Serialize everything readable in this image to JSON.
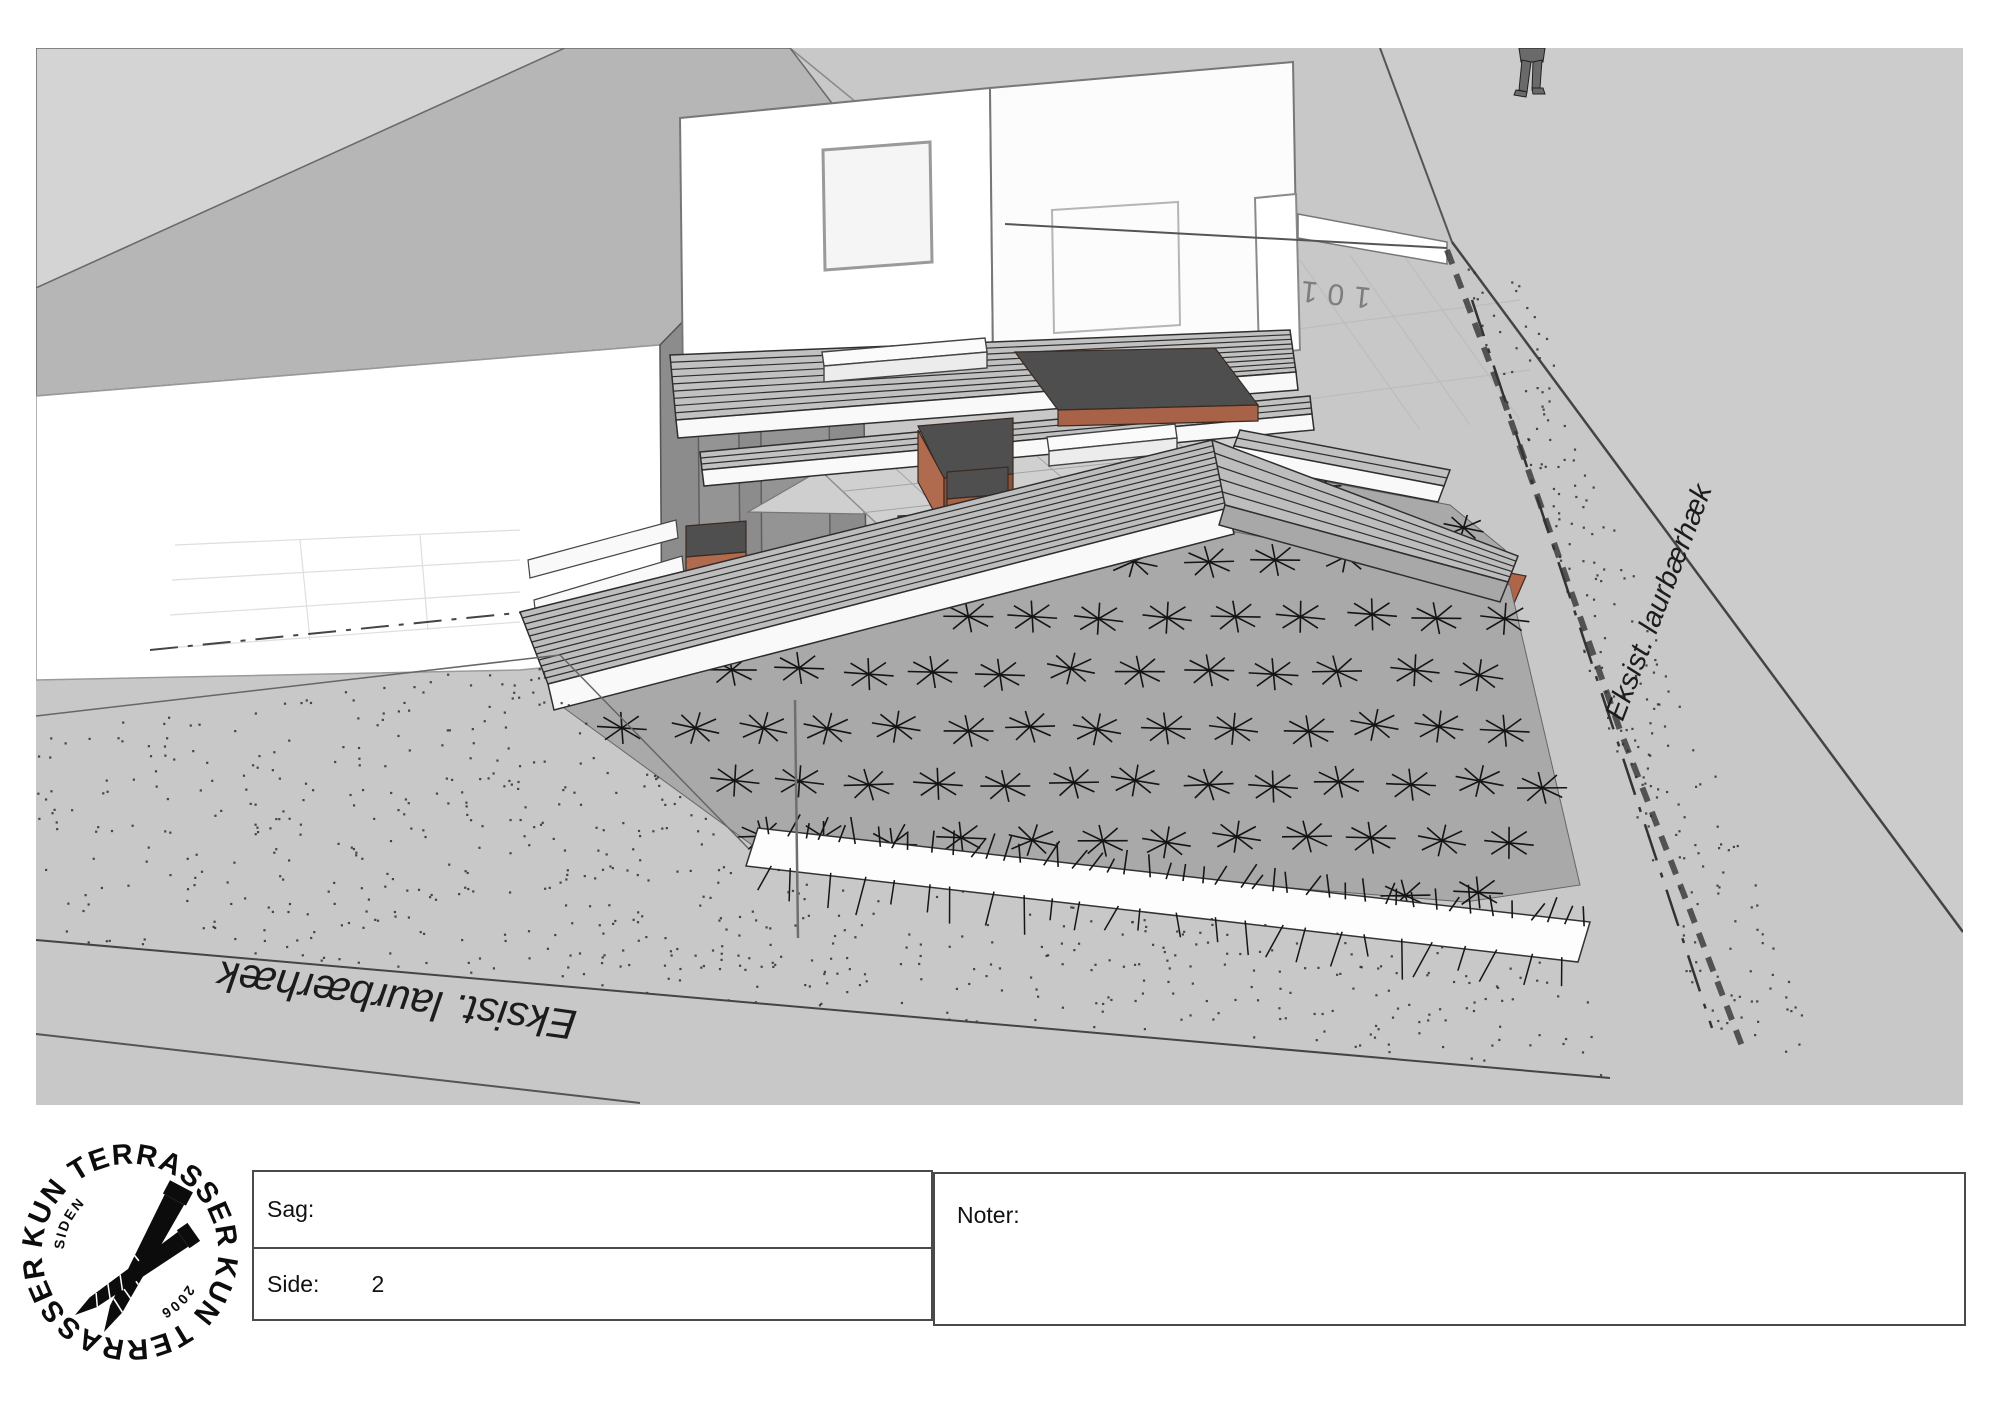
{
  "sheet": {
    "labels": {
      "hedge_bottom": "Eksist. laurbærhæk",
      "hedge_right": "Eksist. laurbærhæk",
      "house_number": "101"
    }
  },
  "logo": {
    "arc_top": "KUN TERRASSER",
    "arc_bottom": "KUN TERRASSER",
    "siden": "SIDEN",
    "year": "2006"
  },
  "title_block": {
    "sag_label": "Sag:",
    "sag_value": "",
    "side_label": "Side:",
    "side_value": "2",
    "noter_label": "Noter:"
  },
  "colors": {
    "ground": "#c8c8c8",
    "roof_light": "#d4d4d4",
    "roof_main": "#b6b6b6",
    "wall_dark": "#8c8c8c",
    "white_wall": "#ffffff",
    "deck": "#c1c1c1",
    "deck_lower": "#bdbdbd",
    "deck_line": "#2e2e2e",
    "fascia": "#f9f9f9",
    "patio": "#d0d0d0",
    "patio_line": "#a4a4a4",
    "bed": "#a9a9a9",
    "terracotta": "#b06a4e",
    "terracotta_dark": "#8e5138",
    "soil": "#4f4f4f",
    "ink": "#1a1a1a",
    "stipple": "#2e2e2e"
  }
}
